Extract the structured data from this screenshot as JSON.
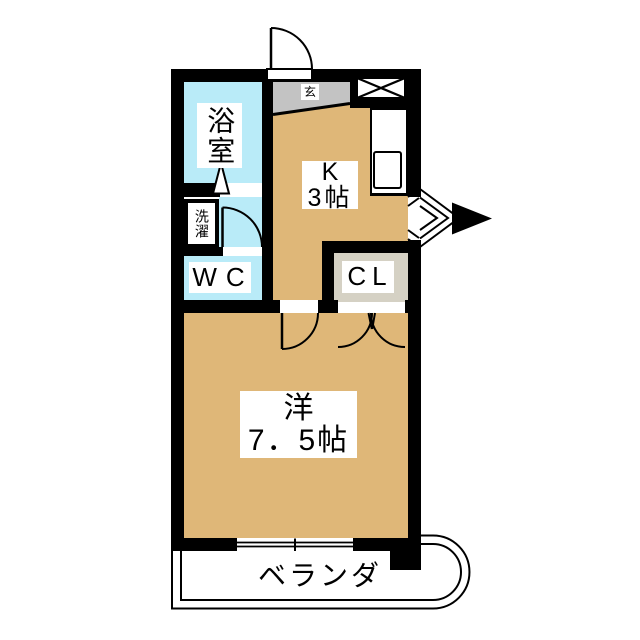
{
  "colors": {
    "wall": "#000000",
    "room_tan": "#dfb778",
    "wet_cyan": "#b9ebf8",
    "genkan_gray": "#c3c3c3",
    "closet_greige": "#d5d1c4"
  },
  "rooms": {
    "bathroom": {
      "label": "浴室"
    },
    "genkan": {
      "label": "玄"
    },
    "kitchen": {
      "line1": "K",
      "line2": "3帖"
    },
    "laundry": {
      "label": "洗濯"
    },
    "wc": {
      "label": "WC"
    },
    "closet": {
      "label": "CL"
    },
    "western": {
      "line1": "洋",
      "line2": "7．5帖"
    },
    "veranda": {
      "label": "ベランダ"
    }
  }
}
